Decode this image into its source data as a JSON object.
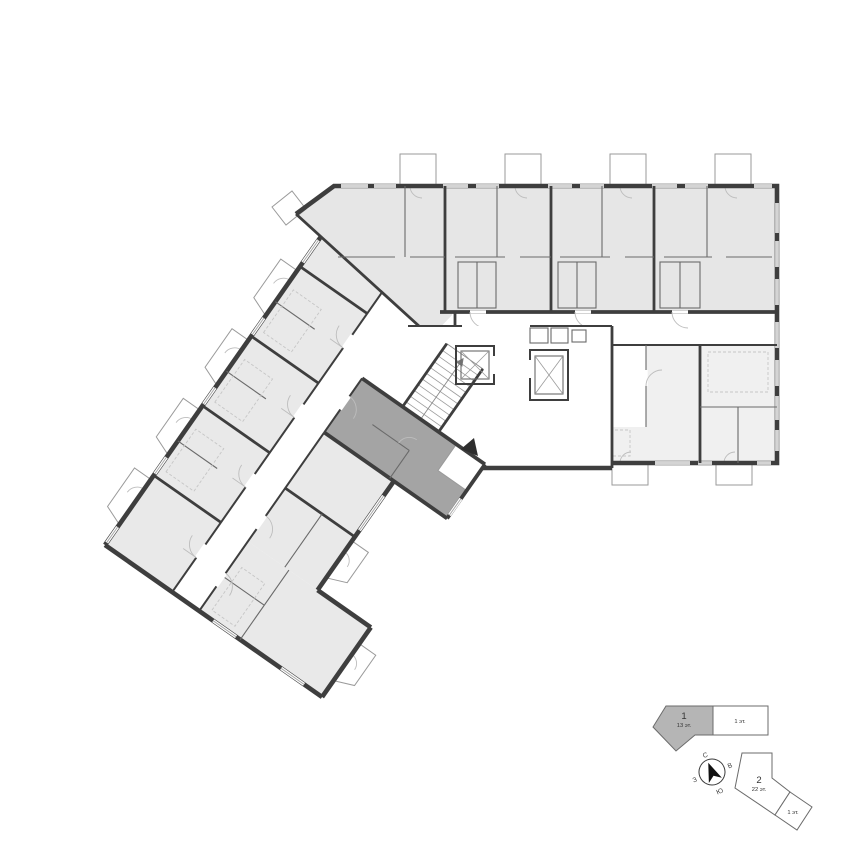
{
  "legend": {
    "building_1": {
      "number": "1",
      "floors_label": "13 эт.",
      "annex_label": "1 эт."
    },
    "building_2": {
      "number": "2",
      "floors_label": "22 эт.",
      "annex_label": "1 эт."
    },
    "compass": {
      "north": "С",
      "east": "В",
      "south": "Ю",
      "west": "З"
    }
  },
  "colors": {
    "wall": "#3e3e3e",
    "apartment_fill": "#e9e9e9",
    "apartment_fill_dark": "#e6e6e6",
    "apartment_fill_light": "#f0f0f0",
    "highlight_fill": "#a4a4a4",
    "legend_fill": "#b5b5b5"
  }
}
